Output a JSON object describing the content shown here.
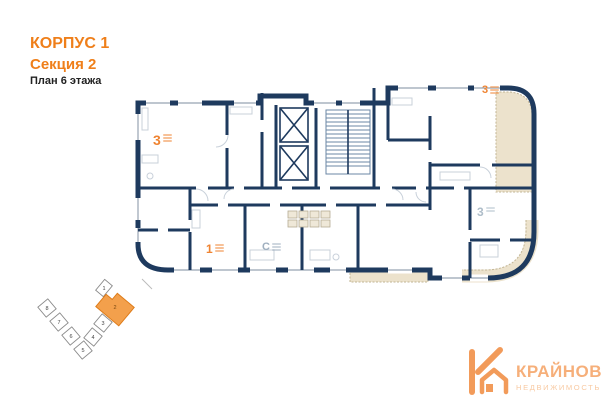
{
  "header": {
    "building": "КОРПУС 1",
    "section": "Секция 2",
    "floor": "План 6 этажа"
  },
  "apartments": [
    {
      "label": "3",
      "position": "top-left"
    },
    {
      "label": "3",
      "position": "top-right"
    },
    {
      "label": "1",
      "position": "bottom-left"
    },
    {
      "label": "С",
      "position": "bottom-center"
    },
    {
      "label": "3",
      "position": "bottom-right"
    }
  ],
  "minimap": {
    "sections": [
      {
        "n": "1",
        "active": false
      },
      {
        "n": "2",
        "active": true
      },
      {
        "n": "3",
        "active": false
      },
      {
        "n": "4",
        "active": false
      },
      {
        "n": "5",
        "active": false
      },
      {
        "n": "6",
        "active": false
      },
      {
        "n": "7",
        "active": false
      },
      {
        "n": "8",
        "active": false
      }
    ]
  },
  "logo": {
    "name": "КРАЙНОВ",
    "tagline": "НЕДВИЖИМОСТЬ"
  },
  "colors": {
    "wall": "#1e3a5e",
    "accent": "#ef7f1a",
    "balcony": "#ece2cc"
  }
}
